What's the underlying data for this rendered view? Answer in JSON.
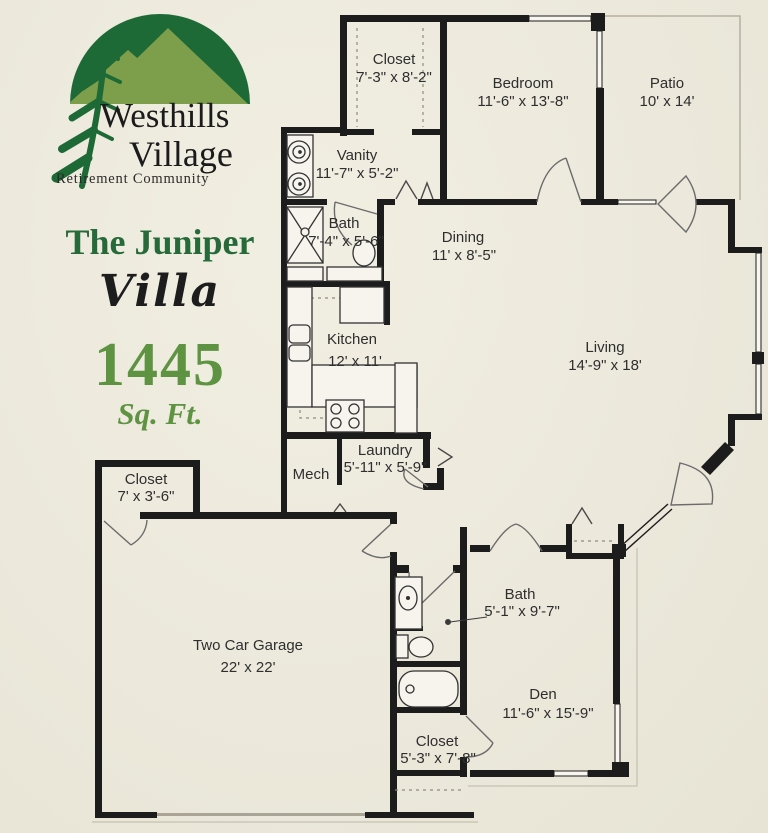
{
  "branding": {
    "logo_title_line1": "Westhills",
    "logo_title_line2": "Village",
    "logo_tagline": "Retirement Community",
    "plan_name": "The Juniper",
    "plan_type": "Villa",
    "square_footage": "1445",
    "square_footage_label": "Sq. Ft.",
    "colors": {
      "logo_dark_green": "#1d6a36",
      "logo_light_green": "#7d9f4b",
      "accent_green": "#5e9342",
      "title_green": "#266a3a",
      "wall_ink": "#1c1c1c",
      "paper": "#ece9dc"
    }
  },
  "floor_plan": {
    "rooms": [
      {
        "name": "Closet",
        "dims": "7'-3\" x 8'-2\""
      },
      {
        "name": "Bedroom",
        "dims": "11'-6\" x 13'-8\""
      },
      {
        "name": "Patio",
        "dims": "10' x 14'"
      },
      {
        "name": "Vanity",
        "dims": "11'-7\" x 5'-2\""
      },
      {
        "name": "Bath",
        "dims": "7'-4\" x 5'-6\""
      },
      {
        "name": "Dining",
        "dims": "11' x 8'-5\""
      },
      {
        "name": "Kitchen",
        "dims": "12' x 11'"
      },
      {
        "name": "Living",
        "dims": "14'-9\" x 18'"
      },
      {
        "name": "Mech",
        "dims": ""
      },
      {
        "name": "Laundry",
        "dims": "5'-11\" x 5'-9\""
      },
      {
        "name": "Closet",
        "dims": "7' x 3'-6\""
      },
      {
        "name": "Two Car Garage",
        "dims": "22' x 22'"
      },
      {
        "name": "Bath",
        "dims": "5'-1\" x 9'-7\""
      },
      {
        "name": "Den",
        "dims": "11'-6\" x 15'-9\""
      },
      {
        "name": "Closet",
        "dims": "5'-3\" x 7'-8\""
      }
    ]
  }
}
